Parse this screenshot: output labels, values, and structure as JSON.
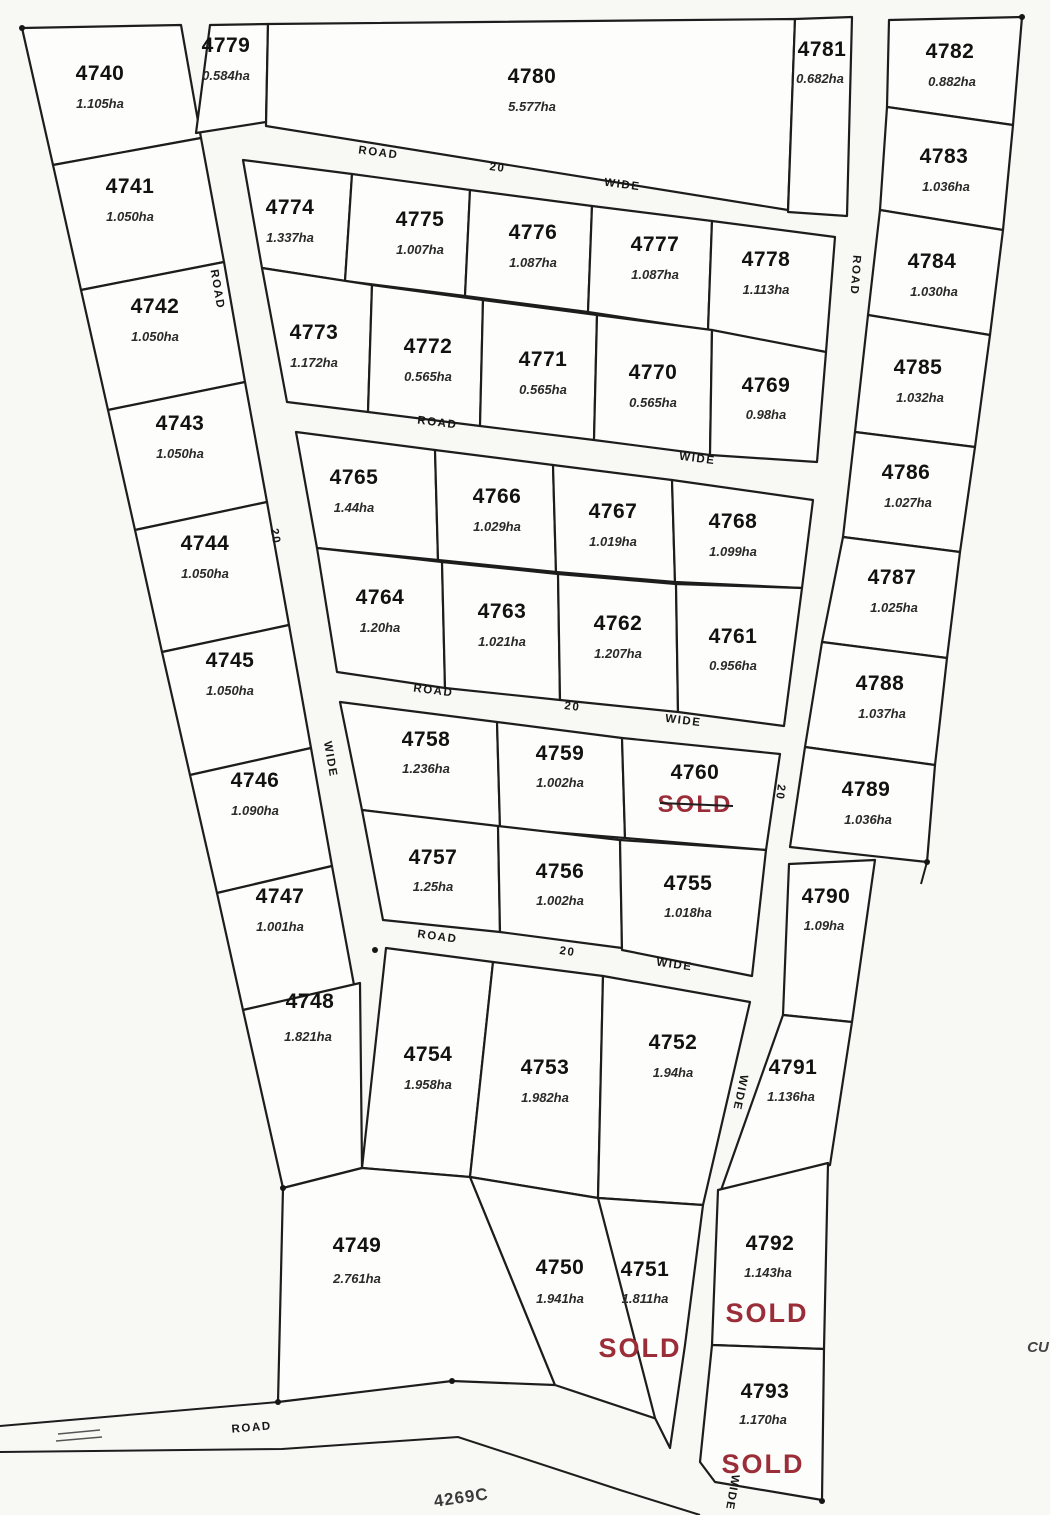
{
  "map_title": "Subdivision lot plan",
  "lots": {
    "4740": {
      "id": "4740",
      "area": "1.105ha"
    },
    "4741": {
      "id": "4741",
      "area": "1.050ha"
    },
    "4742": {
      "id": "4742",
      "area": "1.050ha"
    },
    "4743": {
      "id": "4743",
      "area": "1.050ha"
    },
    "4744": {
      "id": "4744",
      "area": "1.050ha"
    },
    "4745": {
      "id": "4745",
      "area": "1.050ha"
    },
    "4746": {
      "id": "4746",
      "area": "1.090ha"
    },
    "4747": {
      "id": "4747",
      "area": "1.001ha"
    },
    "4748": {
      "id": "4748",
      "area": "1.821ha"
    },
    "4749": {
      "id": "4749",
      "area": "2.761ha"
    },
    "4750": {
      "id": "4750",
      "area": "1.941ha"
    },
    "4751": {
      "id": "4751",
      "area": "1.811ha",
      "sold": "SOLD"
    },
    "4752": {
      "id": "4752",
      "area": "1.94ha"
    },
    "4753": {
      "id": "4753",
      "area": "1.982ha"
    },
    "4754": {
      "id": "4754",
      "area": "1.958ha"
    },
    "4755": {
      "id": "4755",
      "area": "1.018ha"
    },
    "4756": {
      "id": "4756",
      "area": "1.002ha"
    },
    "4757": {
      "id": "4757",
      "area": "1.25ha"
    },
    "4758": {
      "id": "4758",
      "area": "1.236ha"
    },
    "4759": {
      "id": "4759",
      "area": "1.002ha"
    },
    "4760": {
      "id": "4760",
      "sold": "SOLD"
    },
    "4761": {
      "id": "4761",
      "area": "0.956ha"
    },
    "4762": {
      "id": "4762",
      "area": "1.207ha"
    },
    "4763": {
      "id": "4763",
      "area": "1.021ha"
    },
    "4764": {
      "id": "4764",
      "area": "1.20ha"
    },
    "4765": {
      "id": "4765",
      "area": "1.44ha"
    },
    "4766": {
      "id": "4766",
      "area": "1.029ha"
    },
    "4767": {
      "id": "4767",
      "area": "1.019ha"
    },
    "4768": {
      "id": "4768",
      "area": "1.099ha"
    },
    "4769": {
      "id": "4769",
      "area": "0.98ha"
    },
    "4770": {
      "id": "4770",
      "area": "0.565ha"
    },
    "4771": {
      "id": "4771",
      "area": "0.565ha"
    },
    "4772": {
      "id": "4772",
      "area": "0.565ha"
    },
    "4773": {
      "id": "4773",
      "area": "1.172ha"
    },
    "4774": {
      "id": "4774",
      "area": "1.337ha"
    },
    "4775": {
      "id": "4775",
      "area": "1.007ha"
    },
    "4776": {
      "id": "4776",
      "area": "1.087ha"
    },
    "4777": {
      "id": "4777",
      "area": "1.087ha"
    },
    "4778": {
      "id": "4778",
      "area": "1.113ha"
    },
    "4779": {
      "id": "4779",
      "area": "0.584ha"
    },
    "4780": {
      "id": "4780",
      "area": "5.577ha"
    },
    "4781": {
      "id": "4781",
      "area": "0.682ha"
    },
    "4782": {
      "id": "4782",
      "area": "0.882ha"
    },
    "4783": {
      "id": "4783",
      "area": "1.036ha"
    },
    "4784": {
      "id": "4784",
      "area": "1.030ha"
    },
    "4785": {
      "id": "4785",
      "area": "1.032ha"
    },
    "4786": {
      "id": "4786",
      "area": "1.027ha"
    },
    "4787": {
      "id": "4787",
      "area": "1.025ha"
    },
    "4788": {
      "id": "4788",
      "area": "1.037ha"
    },
    "4789": {
      "id": "4789",
      "area": "1.036ha"
    },
    "4790": {
      "id": "4790",
      "area": "1.09ha"
    },
    "4791": {
      "id": "4791",
      "area": "1.136ha"
    },
    "4792": {
      "id": "4792",
      "area": "1.143ha",
      "sold": "SOLD"
    },
    "4793": {
      "id": "4793",
      "area": "1.170ha",
      "sold": "SOLD"
    }
  },
  "roads": {
    "h1": {
      "name": "ROAD",
      "width_label": "20",
      "wide": "WIDE"
    },
    "h2": {
      "name": "ROAD",
      "wide": "WIDE"
    },
    "h3": {
      "name": "ROAD",
      "width_label": "20",
      "wide": "WIDE"
    },
    "h4": {
      "name": "ROAD",
      "width_label": "20",
      "wide": "WIDE"
    },
    "left_vertical": {
      "name": "ROAD",
      "width_label": "20",
      "wide": "WIDE"
    },
    "right_vertical": {
      "name": "ROAD",
      "width_label": "20",
      "wide": "WIDE",
      "wide2": "WIDE"
    },
    "bottom": {
      "name": "ROAD"
    }
  },
  "annotations": {
    "plan_number": "4269C",
    "edge_text": "CU"
  },
  "colors": {
    "sold_red": "#9b2d38",
    "line_black": "#1d1d1d",
    "paper": "#f8f8f5"
  }
}
